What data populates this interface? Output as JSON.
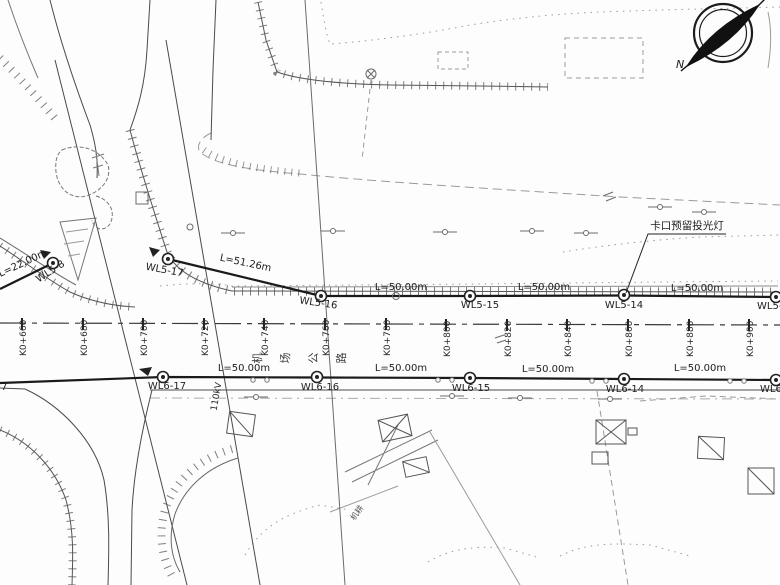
{
  "north_arrow": {
    "label": "N"
  },
  "annotation": {
    "text": "卡口预留投光灯"
  },
  "power_line": {
    "label": "110kV"
  },
  "road": {
    "name_chars": [
      "机",
      "场",
      "公",
      "路"
    ],
    "stations": [
      "K0+660",
      "K0+680",
      "K0+700",
      "K0+720",
      "K0+740",
      "K0+760",
      "K0+780",
      "K0+800",
      "K0+820",
      "K0+840",
      "K0+860",
      "K0+880",
      "K0+900"
    ]
  },
  "lighting": {
    "top_run": {
      "circuit": "WL5",
      "lamps": [
        "WL5-8",
        "WL5-17",
        "WL5-16",
        "WL5-15",
        "WL5-14",
        "WL5-13"
      ],
      "segment_lengths": [
        "L=22.00m",
        "L=51.26m",
        "L=50.00m",
        "L=50.00m",
        "L=50.00m"
      ]
    },
    "bottom_run": {
      "circuit": "WL6",
      "lamps": [
        "7",
        "WL6-17",
        "WL6-16",
        "WL6-15",
        "WL6-14",
        "WL6-13"
      ],
      "segment_lengths": [
        "L=50.00m",
        "L=50.00m",
        "L=50.00m",
        "L=50.00m"
      ]
    }
  },
  "field_note": {
    "text": "机耕"
  }
}
